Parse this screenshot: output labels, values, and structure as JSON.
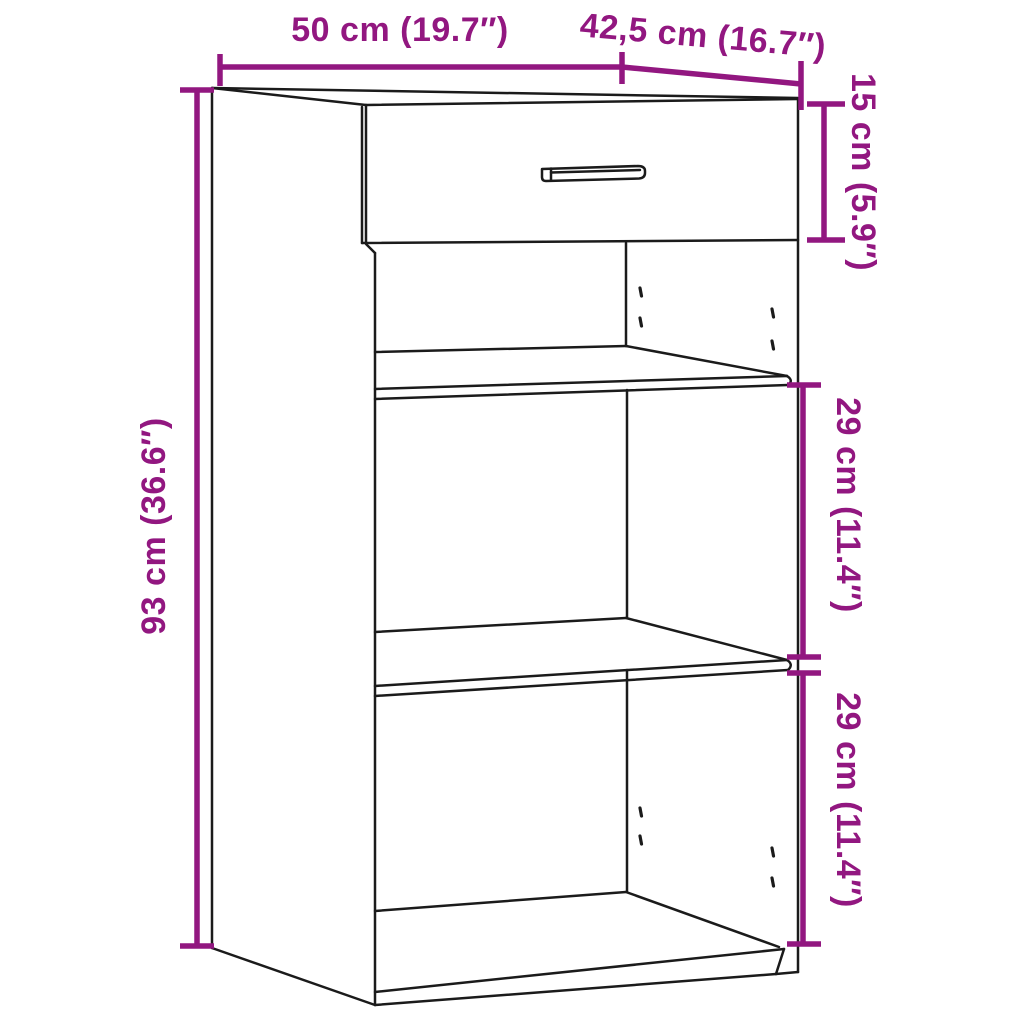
{
  "diagram": {
    "type": "furniture-dimension-diagram",
    "subject": "Cabinet with top drawer and two open shelf compartments",
    "accent_color": "#921780",
    "line_color": "#1b1b1b",
    "background_color": "#ffffff",
    "dimensions": {
      "width": {
        "label": "50 cm (19.7″)",
        "value_cm": "50",
        "value_inch": "19.7"
      },
      "depth": {
        "label": "42,5 cm (16.7″)",
        "value_cm": "42,5",
        "value_inch": "16.7"
      },
      "drawer_height": {
        "label": "15 cm (5.9″)",
        "value_cm": "15",
        "value_inch": "5.9"
      },
      "total_height": {
        "label": "93 cm (36.6″)",
        "value_cm": "93",
        "value_inch": "36.6"
      },
      "middle_compartment": {
        "label": "29 cm (11.4″)",
        "value_cm": "29",
        "value_inch": "11.4"
      },
      "bottom_compartment": {
        "label": "29 cm (11.4″)",
        "value_cm": "29",
        "value_inch": "11.4"
      }
    }
  }
}
